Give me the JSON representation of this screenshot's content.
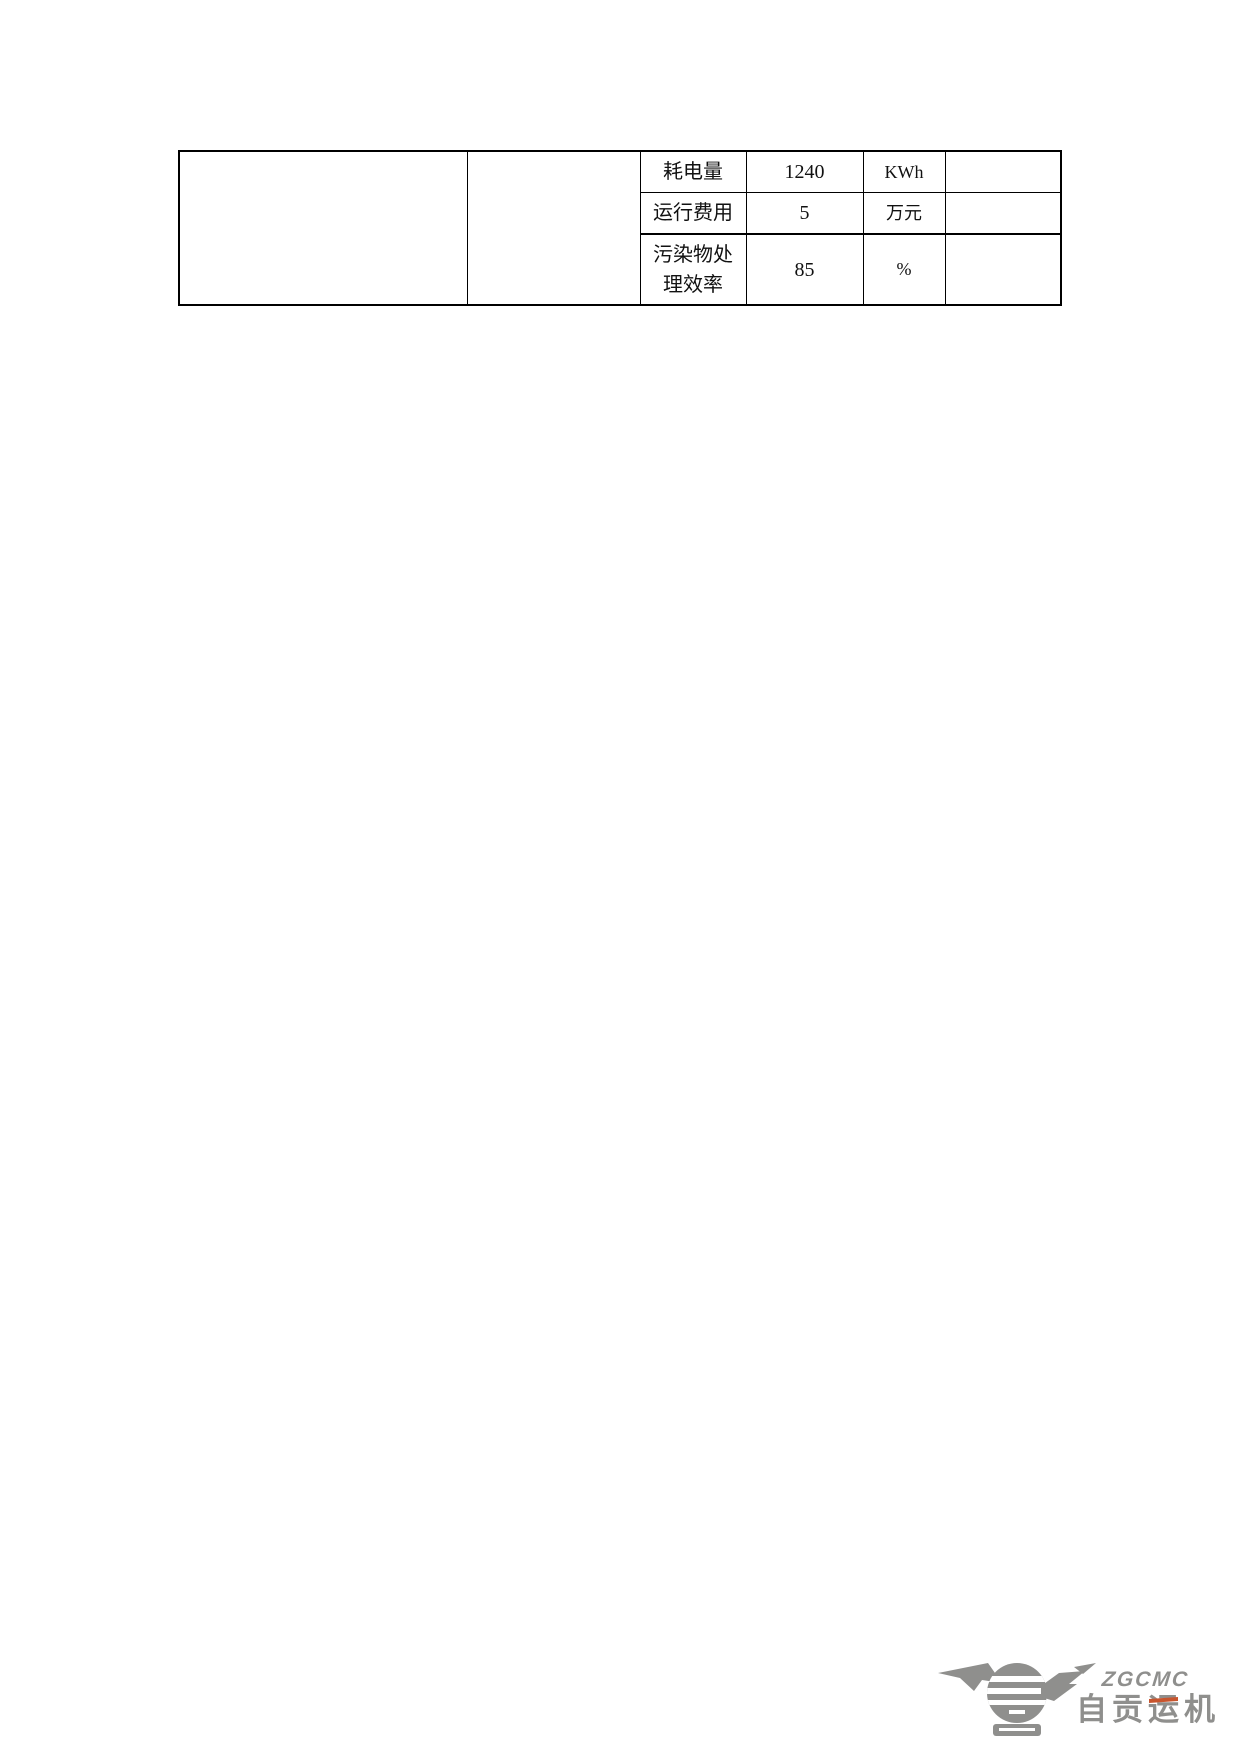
{
  "document": {
    "background": "#ffffff",
    "border_color": "#000000"
  },
  "table": {
    "rows": [
      {
        "label": "耗电量",
        "value": "1240",
        "unit": "KWh"
      },
      {
        "label": "运行费用",
        "value": "5",
        "unit": "万元"
      },
      {
        "label": "污染物处理效率",
        "value": "85",
        "unit": "%"
      }
    ]
  },
  "logo": {
    "acronym": "ZGCMC",
    "name_prefix": "自贡",
    "name_yun": "运",
    "name_suffix": "机",
    "gray": "#8f8f8d",
    "accent": "#c8552e"
  }
}
